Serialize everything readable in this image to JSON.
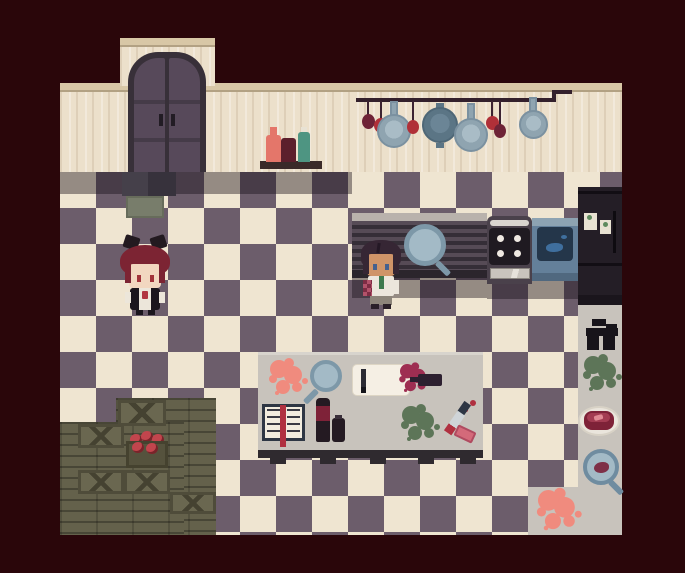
{
  "scene": {
    "name": "pixel-art kitchen room",
    "style": "top-down RPG pixel art",
    "text_visible": "none"
  },
  "palette": {
    "background": "#2a060a",
    "wall": "#ece0cb",
    "wall_trim": "#d8c7a6",
    "floor_light": "#efe5d1",
    "floor_dark": "#6c5d6b",
    "counter_gray": "#c8c3bc",
    "wood": "#64614b",
    "crate": "#6a6750",
    "door_frame": "#383039",
    "door_leaf": "#57495a",
    "appliance_dark": "#241e26",
    "pan_blue": "#7d98a8",
    "red_accent": "#c2454d",
    "maroon_accent": "#6e2336",
    "green_splat": "#5d7558",
    "pink_splat": "#f08b7e",
    "wine_red": "#9e2e52",
    "teal_bottle": "#4e9582",
    "steak_red": "#7e2238",
    "hair_red": "#7c2433",
    "hair_dark": "#362634",
    "skin_pale": "#f2d7c0",
    "skin_tan": "#cf9468",
    "tie_green": "#3e7a4e"
  },
  "objects": {
    "door": {
      "label": "wooden double door"
    },
    "doormat": {
      "label": "doormat tiles"
    },
    "shelf": {
      "label": "wall shelf with bottles",
      "bottles": [
        "salmon bottle",
        "dark red bottle",
        "teal bottle"
      ]
    },
    "rack": {
      "label": "hanging rod with pans and onions",
      "items": [
        "dark onion",
        "red onion",
        "frying pan",
        "red onion",
        "front-facing pan",
        "frying pan",
        "red onion",
        "dark onion",
        "small pan"
      ]
    },
    "counter": {
      "label": "ribbed kitchen counter"
    },
    "counter_magnifier": {
      "label": "magnifying glass on counter"
    },
    "stove": {
      "label": "four-burner stove with oven",
      "burners": 4
    },
    "sink": {
      "label": "kitchen sink with basin"
    },
    "fridge": {
      "label": "dark refrigerator with two notes",
      "notes": 2
    },
    "table": {
      "label": "kitchen work table",
      "items": {
        "pink_splat": "pink splatter",
        "magnifier": "magnifying glass",
        "cutting_board": "cutting board with knife",
        "spilled_bottle": "tipped wine bottle with spill",
        "book": "open recipe book with red ribbon",
        "bottles": "tall bottle and small jar",
        "green_splat": "green splatter",
        "knives": "bloodied knives"
      }
    },
    "crates": {
      "label": "stacked wooden crates",
      "tomato_crate": "crate of tomatoes",
      "planks": "wooden floor planks"
    },
    "side_counter": {
      "label": "right side counter",
      "items": {
        "grinder": "meat grinder",
        "green_splat": "green splatter",
        "steak": "steak on a plate",
        "stain_magnifier": "magnifying glass over stain",
        "pink_splat": "pink splatter"
      }
    }
  },
  "characters": [
    {
      "id": "red-haired-character",
      "description": "girl with dark red hair, black bows, black dress with white apron and red brooch",
      "location": "left side of floor"
    },
    {
      "id": "dark-haired-character",
      "description": "person with dark hair, white shirt, green tie, pink checkered sleeve",
      "location": "standing at the counter"
    }
  ]
}
